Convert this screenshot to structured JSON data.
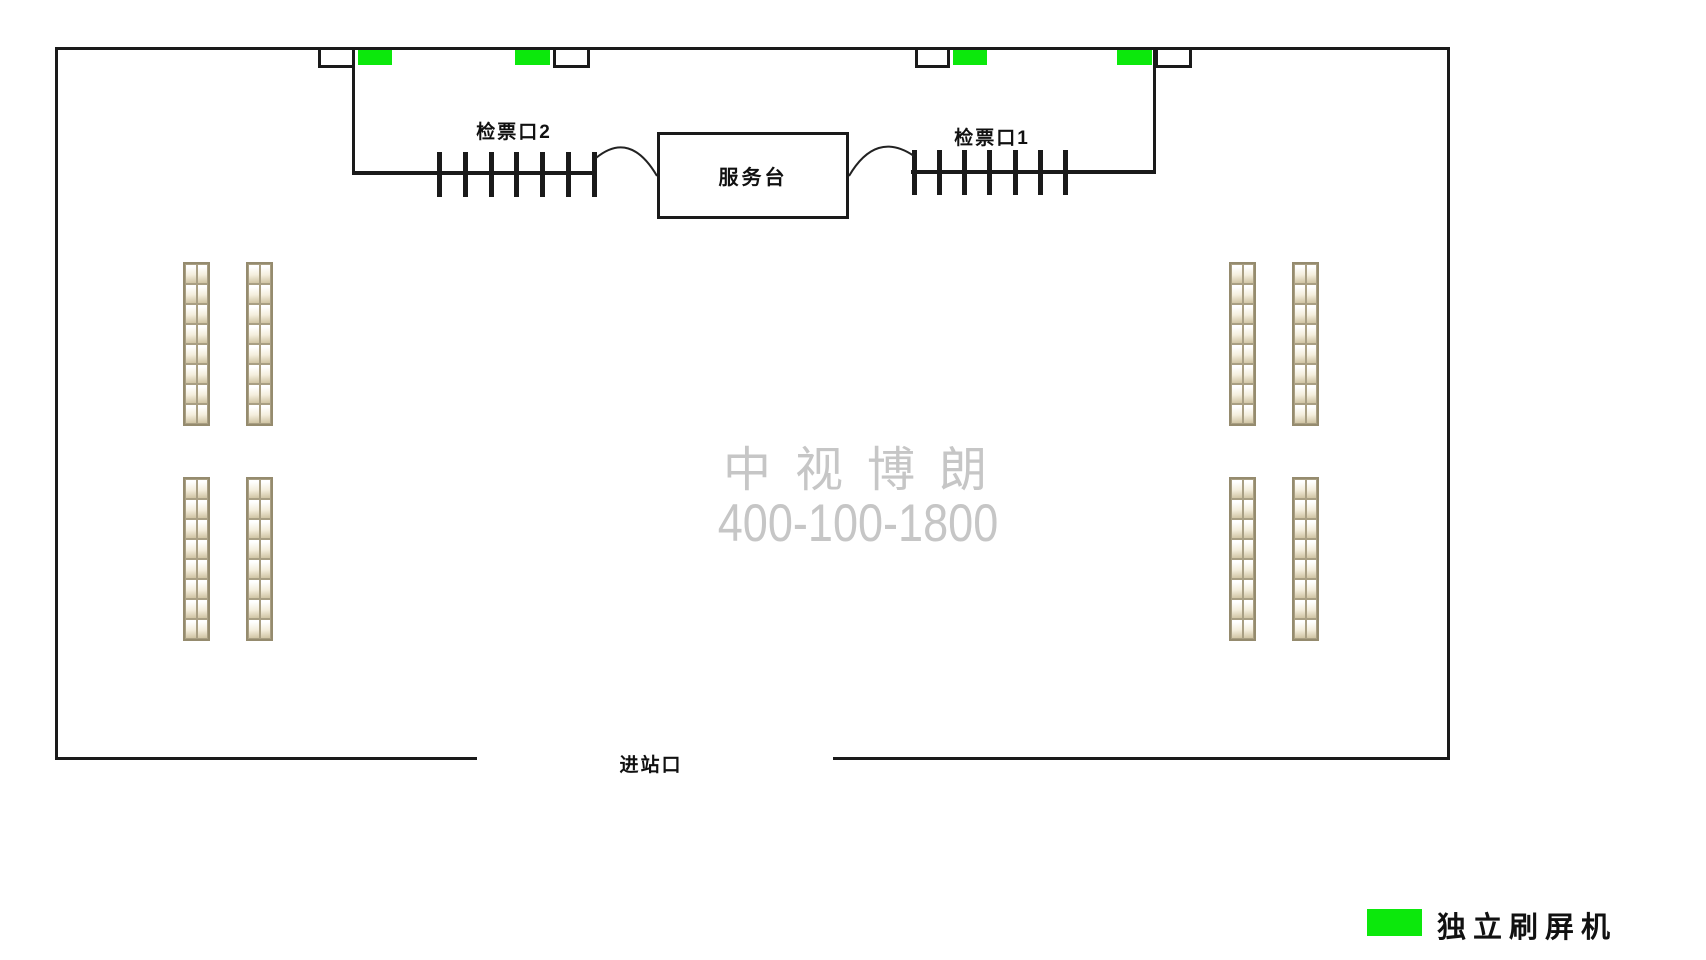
{
  "floor_plan": {
    "labels": {
      "gate_2": "检票口2",
      "gate_1": "检票口1",
      "service_desk": "服务台",
      "entrance": "进站口"
    },
    "watermark": {
      "line1": "中视博朗",
      "line2": "400-100-1800",
      "color": "#c6c6c6"
    },
    "legend": {
      "label": "独立刷屏机",
      "swatch_color": "#0ce80c"
    },
    "colors": {
      "outline": "#1a1a1a",
      "screen_green": "#0ce80c",
      "seat_border": "#a99f83"
    },
    "counts": {
      "turnstiles_per_gate": 7,
      "screen_machines": 4,
      "gate_doors": 4,
      "seat_groups": 4,
      "seat_columns_per_group": 2,
      "seat_rows_per_column": 8,
      "seat_cells_per_row": 2
    }
  }
}
